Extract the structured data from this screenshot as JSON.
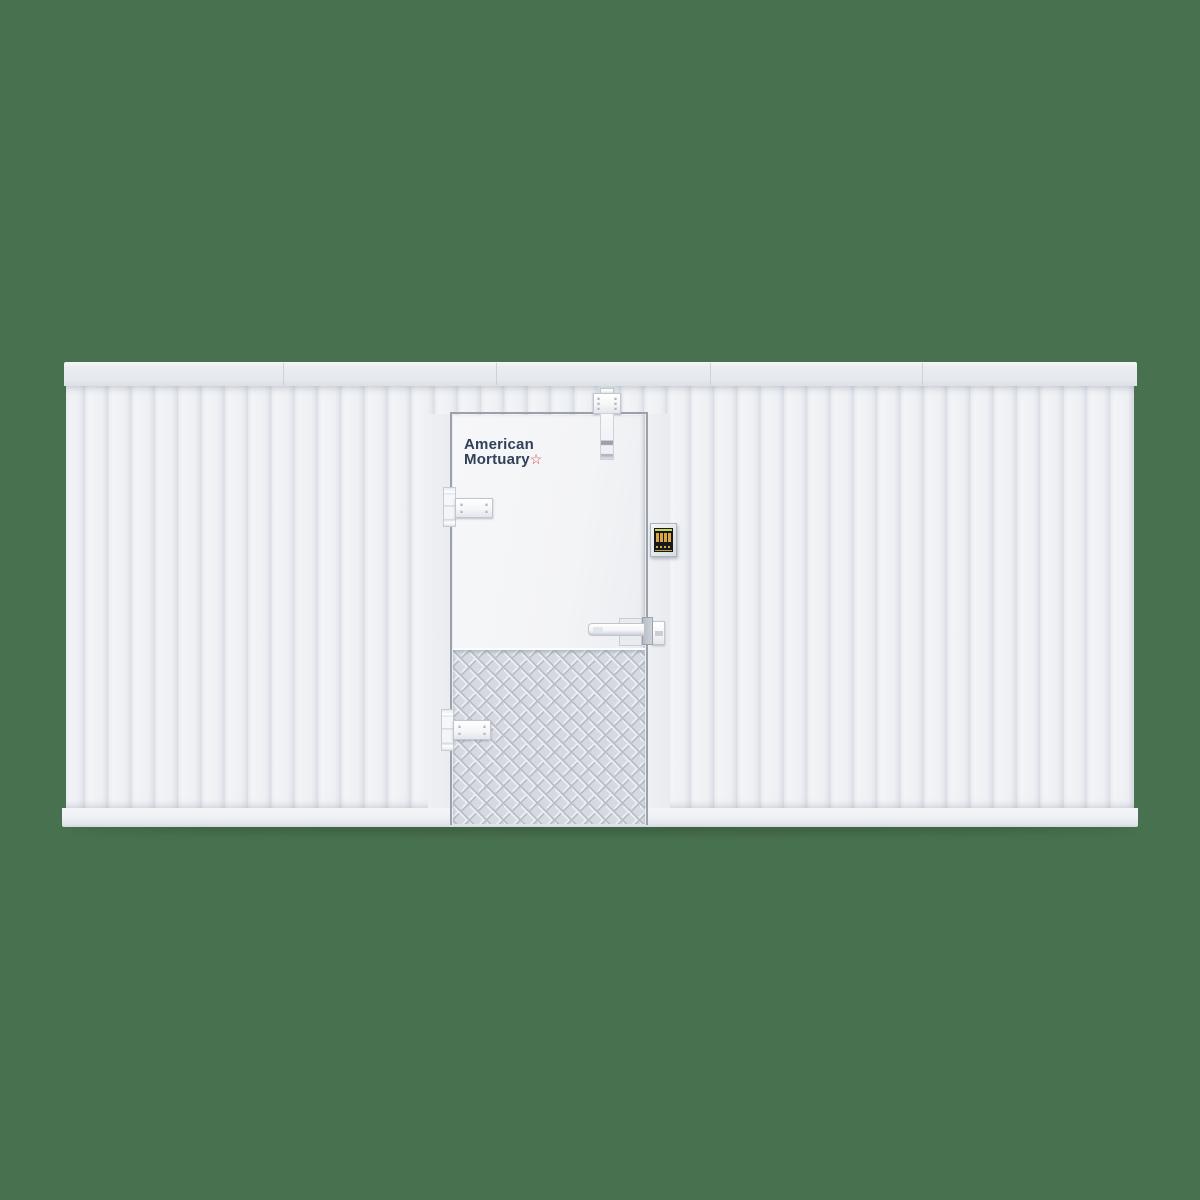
{
  "scene": {
    "description": "3D product render of a white walk-in mortuary cooler wall section with corrugated insulated panels and a flush service door",
    "background_color": "#48714F"
  },
  "logo": {
    "line1": "American",
    "line2": "Mortuary",
    "star": "☆",
    "text_color": "#32405a",
    "accent_color": "#d8424a"
  },
  "colors": {
    "bg": "#48714F",
    "panel-face": "#f2f4f7",
    "panel-groove": "#dfe3e9",
    "panel-seam": "#d9dce3",
    "cap": "#e6e9ee",
    "trim": "#eff1f5",
    "door-face": "#f3f4f6",
    "frame": "#9aa1aa",
    "tread": "#d6dae0",
    "tread-dark": "#b9bfc9",
    "tread-light": "#eceef2",
    "hw": "#f5f6f8",
    "hw-border": "#c2c7cf",
    "hw-shadow": "#aab0b9",
    "logo-text": "#32405a",
    "logo-accent": "#d8424a",
    "screen-bg": "#17181b",
    "screen-amber": "#d9a844",
    "screen-lime": "#c9d44a"
  },
  "components": {
    "wall": "insulated-panel-wall",
    "top_cap": "top-cap-rail",
    "bottom_trim": "base-trim-rail",
    "door": "walk-in-cooler-door",
    "door_closer": "overhead-cam-door-closer",
    "hinge_top": "strap-hinge",
    "hinge_bottom": "strap-hinge",
    "latch": "bar-latch-handle",
    "temperature_display": "digital-temperature-controller (amber segments on black, lime status bars)",
    "kick_plate": "diamond-tread-kick-plate"
  }
}
